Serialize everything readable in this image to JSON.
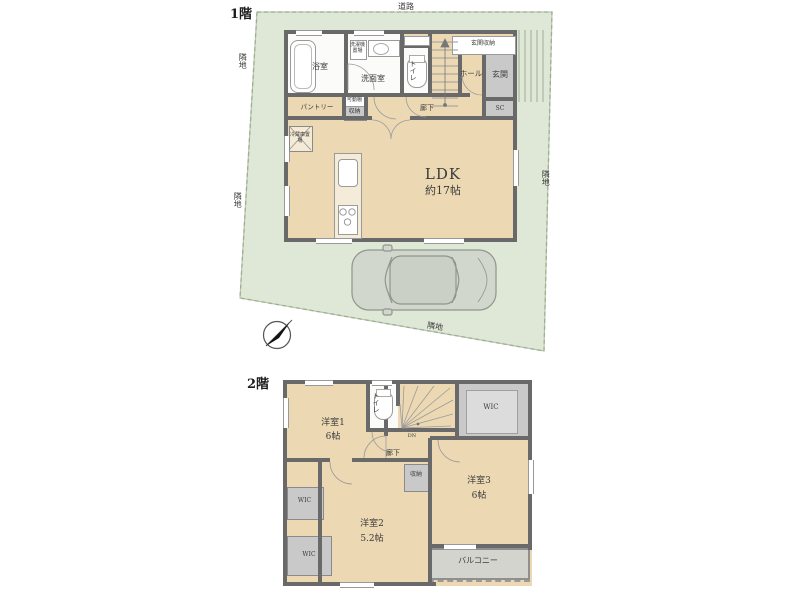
{
  "plan_title": "間取り図",
  "colors": {
    "site_green": "#dfe8d6",
    "floor_tan": "#ecd9b4",
    "wall_gray": "#696969",
    "closet_gray": "#c9c9c9",
    "white_room": "#fbfbfa",
    "car_body": "#d2d7cd"
  },
  "floor1": {
    "label": "1階",
    "road": "道路",
    "neighbor": "隣地",
    "ldk": "LDK",
    "ldk_size": "約17帖",
    "bath": "浴室",
    "washroom": "洗面室",
    "washer": "洗濯機置場",
    "toilet": "トイレ",
    "hall": "ホール",
    "entrance": "玄関",
    "entrance_storage": "玄関収納",
    "shoe_closet": "SC",
    "pantry": "パントリー",
    "corridor": "廊下",
    "storage": "収納",
    "movable_shelf": "可動棚",
    "fridge": "冷蔵庫置場"
  },
  "floor2": {
    "label": "2階",
    "bedroom1": "洋室1",
    "bedroom1_size": "6帖",
    "bedroom2": "洋室2",
    "bedroom2_size": "5.2帖",
    "bedroom3": "洋室3",
    "bedroom3_size": "6帖",
    "toilet": "トイレ",
    "wic": "WIC",
    "corridor": "廊下",
    "storage": "収納",
    "balcony": "バルコニー",
    "down": "DN"
  }
}
